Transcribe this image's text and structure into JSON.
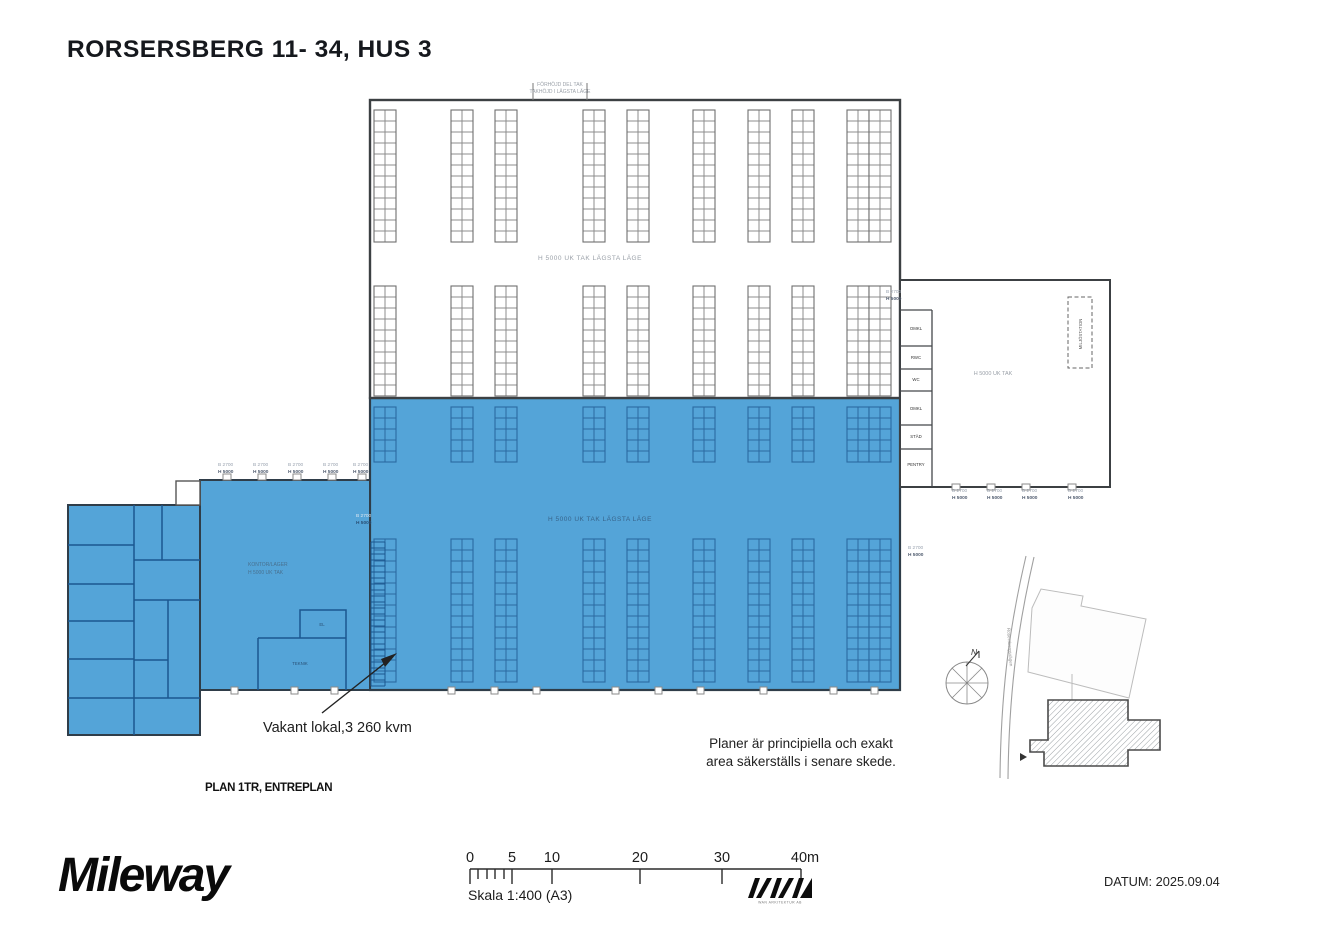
{
  "page": {
    "title": "RORSERSBERG 11- 34, HUS 3",
    "plan_label": "PLAN 1TR, ENTREPLAN",
    "datum": "DATUM: 2025.09.04"
  },
  "branding": {
    "mileway": "Mileway",
    "architect_caption": "WAN ARKITEKTUR AB"
  },
  "scalebar": {
    "ticks": [
      "0",
      "5",
      "10",
      "20",
      "30",
      "40m"
    ],
    "skala": "Skala 1:400 (A3)"
  },
  "annotations": {
    "vacant": "Vakant lokal,3 260 kvm",
    "disclaimer_line1": "Planer är principiella och exakt",
    "disclaimer_line2": "area säkerställs i senare skede."
  },
  "plan": {
    "highlight_color": "#54a4d8",
    "top_label_line1": "FÖRHÖJD DEL TAK",
    "top_label_line2": "TAKHÖJD I LÄGSTA LÄGE",
    "hall_upper_label": "H 5000 UK TAK LÄGSTA LÄGE",
    "hall_lower_label": "H 5000 UK TAK LÄGSTA LÄGE",
    "annex_label": "H 5000 UK TAK",
    "midleft_label_line1": "KONTOR/LAGER",
    "midleft_label_line2": "H 5000 UK TAK",
    "dim_b": "B 2700",
    "dim_h": "H 5000",
    "rooms": {
      "omkl1": "OMKL",
      "rwc": "RWC",
      "wc": "WC",
      "omkl2": "OMKL",
      "stad": "STÄD",
      "pentry": "PENTRY",
      "el": "EL",
      "teknik": "TEKNIK"
    },
    "miljostation": "MILJÖSTATION"
  },
  "site_plan": {
    "north": "N",
    "road_label": "Rosersbergsvägen"
  }
}
